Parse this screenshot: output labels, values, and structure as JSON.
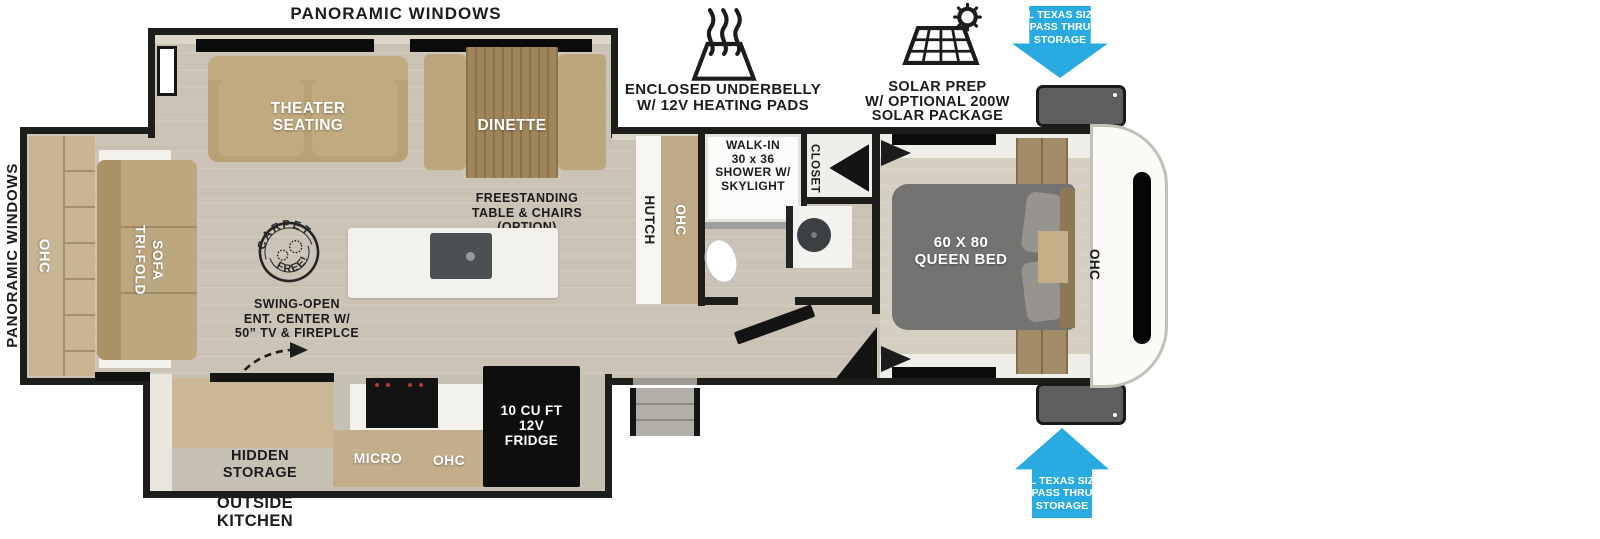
{
  "colors": {
    "accent_blue": "#29ABE2",
    "wall_black": "#1D1D1B",
    "floor_tan": "#CBC4B6",
    "furniture_tan": "#BCA67D",
    "cabinet_tan": "#C2AE8B",
    "bed_gray": "#757372",
    "appliance_black": "#121212",
    "island_white": "#F3F1EC"
  },
  "icons": {
    "underbelly": "heating-pad-icon",
    "solar": "solar-panel-sun-icon",
    "pass_thru_top": "arrow-down-icon",
    "pass_thru_bottom": "arrow-up-icon",
    "carpet": "carpet-free-stamp-icon",
    "swing": "dashed-curve-arrow-icon"
  },
  "callouts": {
    "panoramic_top": "PANORAMIC WINDOWS",
    "panoramic_left": "PANORAMIC WINDOWS",
    "underbelly_label": "ENCLOSED UNDERBELLY\nW/ 12V HEATING PADS",
    "solar_label": "SOLAR PREP\nW/ OPTIONAL 200W\nSOLAR PACKAGE",
    "pass_thru_storage": "XL TEXAS SIZE\nPASS THRU\nSTORAGE",
    "outside_kitchen": "OUTSIDE\nKITCHEN"
  },
  "living": {
    "theater_seating": "THEATER\nSEATING",
    "dinette": "DINETTE",
    "freestanding_option": "FREESTANDING\nTABLE & CHAIRS\n(OPTION)",
    "carpet_stamp_top": "CARPET",
    "carpet_stamp_bottom": "FREE!",
    "rear_ohc": "OHC",
    "tri_fold_sofa": "TRI-FOLD\nSOFA",
    "swing_open_note": "SWING-OPEN\nENT. CENTER W/\n50” TV & FIREPLCE"
  },
  "kitchen": {
    "hidden_storage": "HIDDEN\nSTORAGE",
    "micro": "MICRO",
    "ohc": "OHC",
    "fridge": "10 CU FT\n12V\nFRIDGE",
    "hutch": "HUTCH",
    "hutch_ohc": "OHC"
  },
  "bath": {
    "shower": "WALK-IN\n30 x 36\nSHOWER W/\nSKYLIGHT",
    "closet": "CLOSET"
  },
  "bedroom": {
    "queen_bed": "60 X 80\nQUEEN BED",
    "ohc": "OHC"
  }
}
